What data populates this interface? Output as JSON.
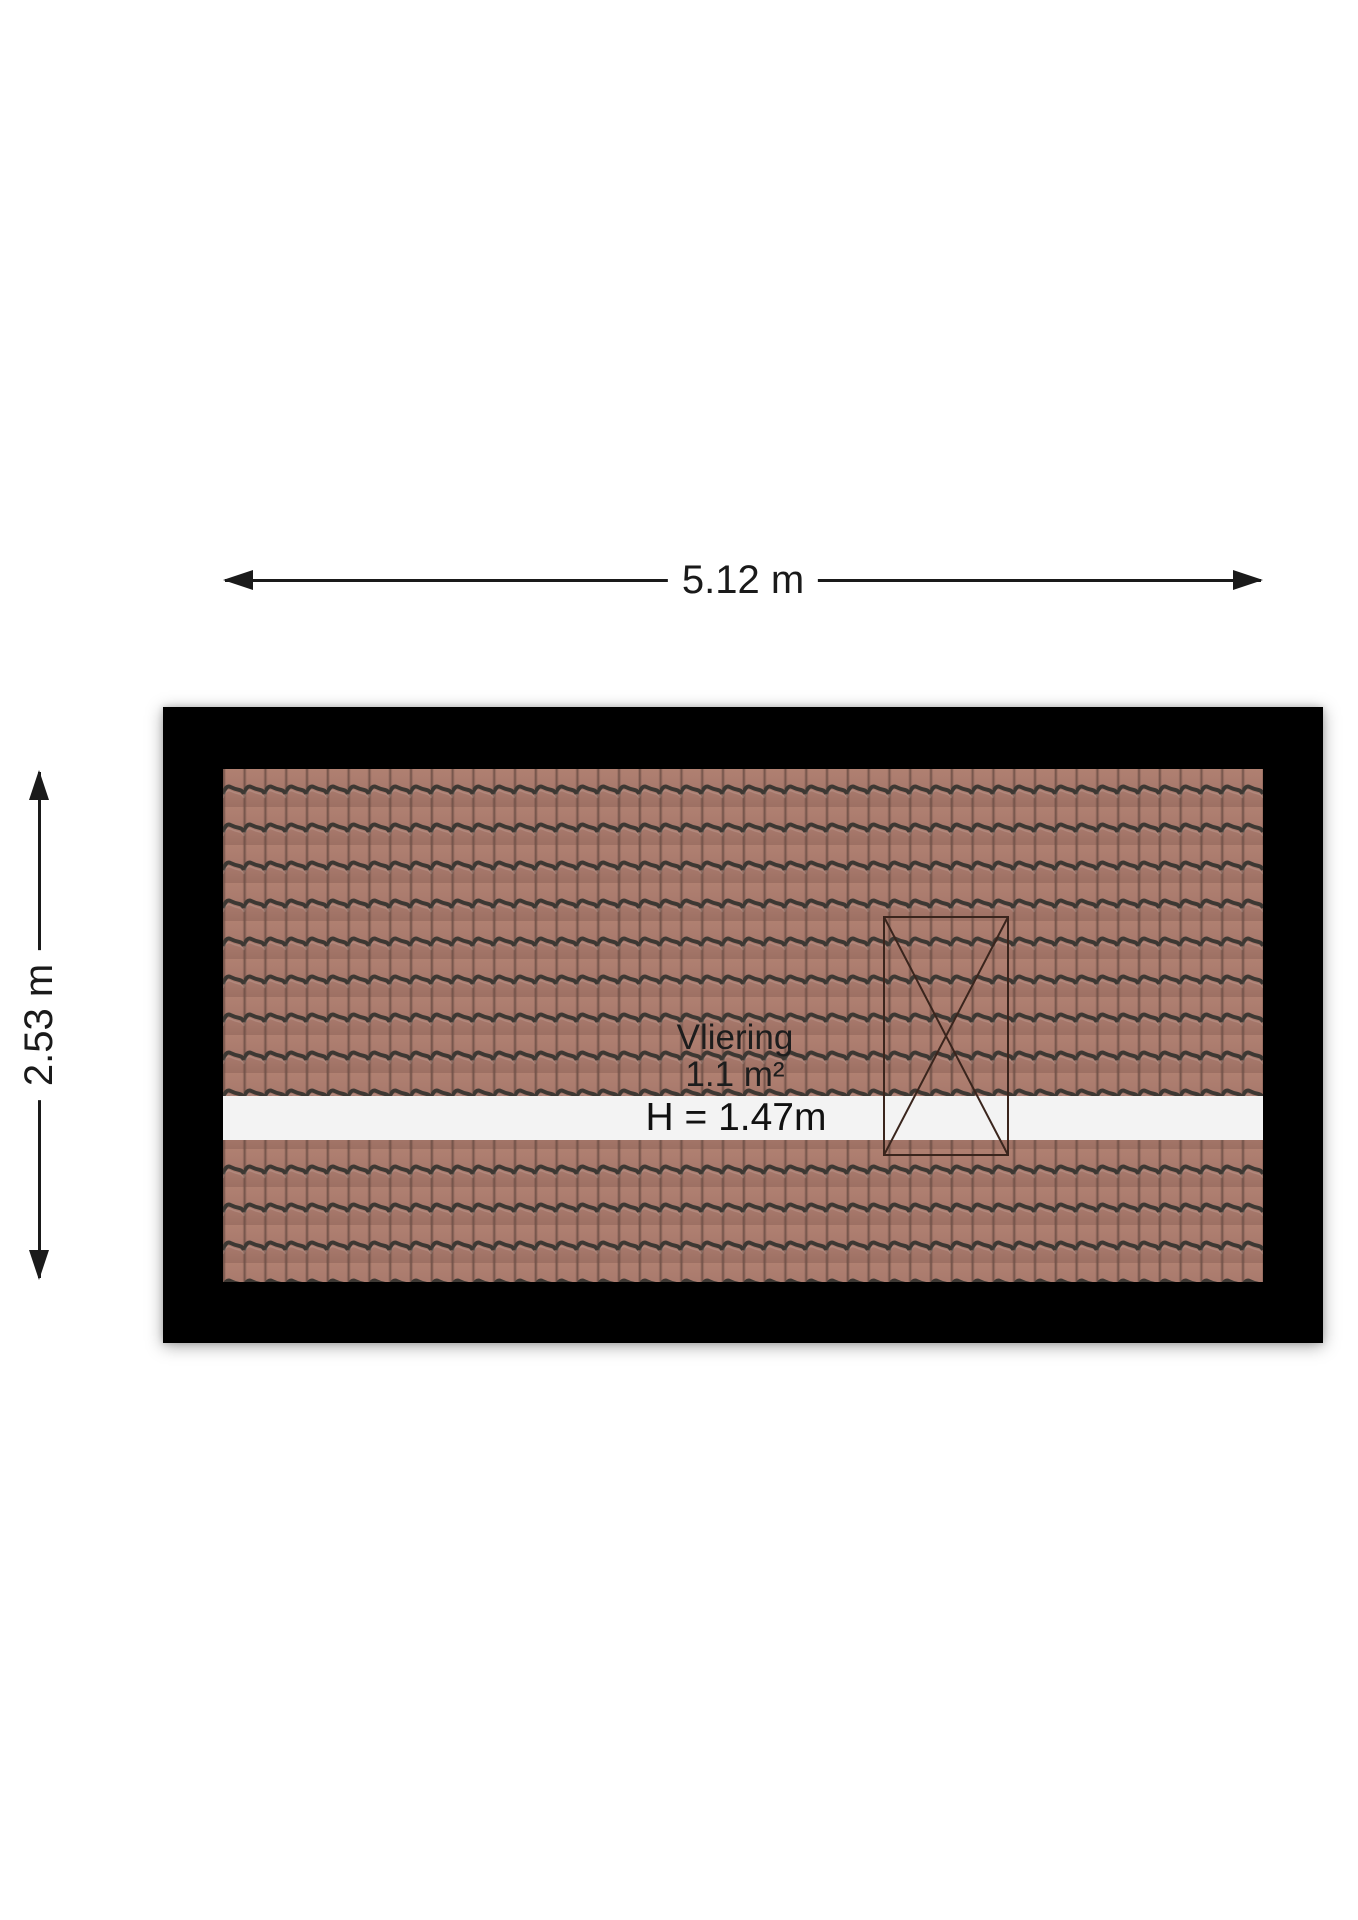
{
  "page": {
    "type": "attic-floorplan",
    "background": "#ffffff"
  },
  "dimension_arrows": {
    "width": {
      "label": "5.12 m"
    },
    "height": {
      "label": "2.53 m"
    }
  },
  "room": {
    "name": "Vliering",
    "area": "1.1 m²",
    "clearance_height": "H = 1.47m"
  },
  "symbols": {
    "roof_window": "rectangle-with-x-cross"
  },
  "colors": {
    "wall": "#000000",
    "roof_tile": "#a8796c",
    "roof_tile_light": "#b08071",
    "roof_tile_dark": "#9d7063",
    "tile_ridge": "#3d3833",
    "tile_joint": "#6e5046",
    "floor_strip": "#f3f3f3",
    "dimension_line": "#1a1a1a",
    "text": "#1d1d1d",
    "window_outline": "#3a251d"
  }
}
